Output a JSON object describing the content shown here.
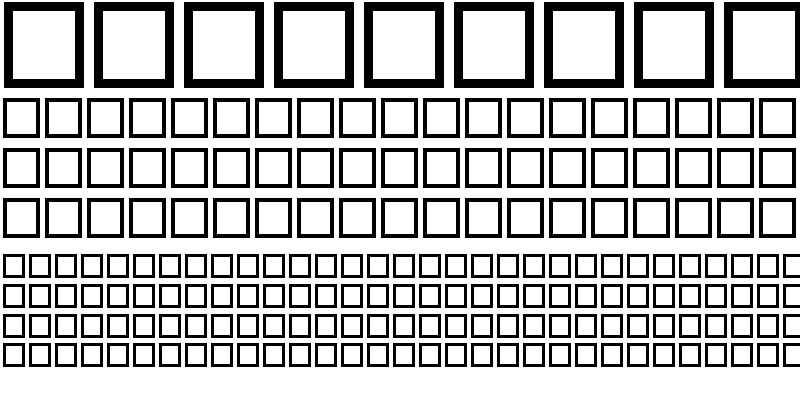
{
  "page": {
    "background_color": "#ffffff",
    "description": "Font character-map preview sheet: every character renders as a hollow black missing-glyph (.notdef) box, shown at three preview sizes"
  },
  "glyph_grid": {
    "box_border_color": "#000000",
    "box_fill_color": "#ffffff",
    "sections": [
      {
        "name": "large-glyph-section",
        "row_name": "large-glyph-row",
        "rows": 1,
        "boxes_per_row": 9,
        "box_width": 80,
        "box_height": 86,
        "border_px": 9,
        "h_gap": 10,
        "v_gap": 0,
        "left": 4,
        "top": 2
      },
      {
        "name": "medium-glyph-section",
        "row_name": "medium-glyph-row",
        "rows": 3,
        "boxes_per_row": 19,
        "box_width": 37,
        "box_height": 40,
        "border_px": 4,
        "h_gap": 5,
        "v_gap": 10,
        "left": 3,
        "top": 98
      },
      {
        "name": "small-glyph-section",
        "row_name": "small-glyph-row",
        "rows": 4,
        "boxes_per_row": 31,
        "box_width": 22,
        "box_height": 24,
        "border_px": 3,
        "h_gap": 4,
        "v_gap": 5.8,
        "left": 3,
        "top": 254
      }
    ]
  }
}
